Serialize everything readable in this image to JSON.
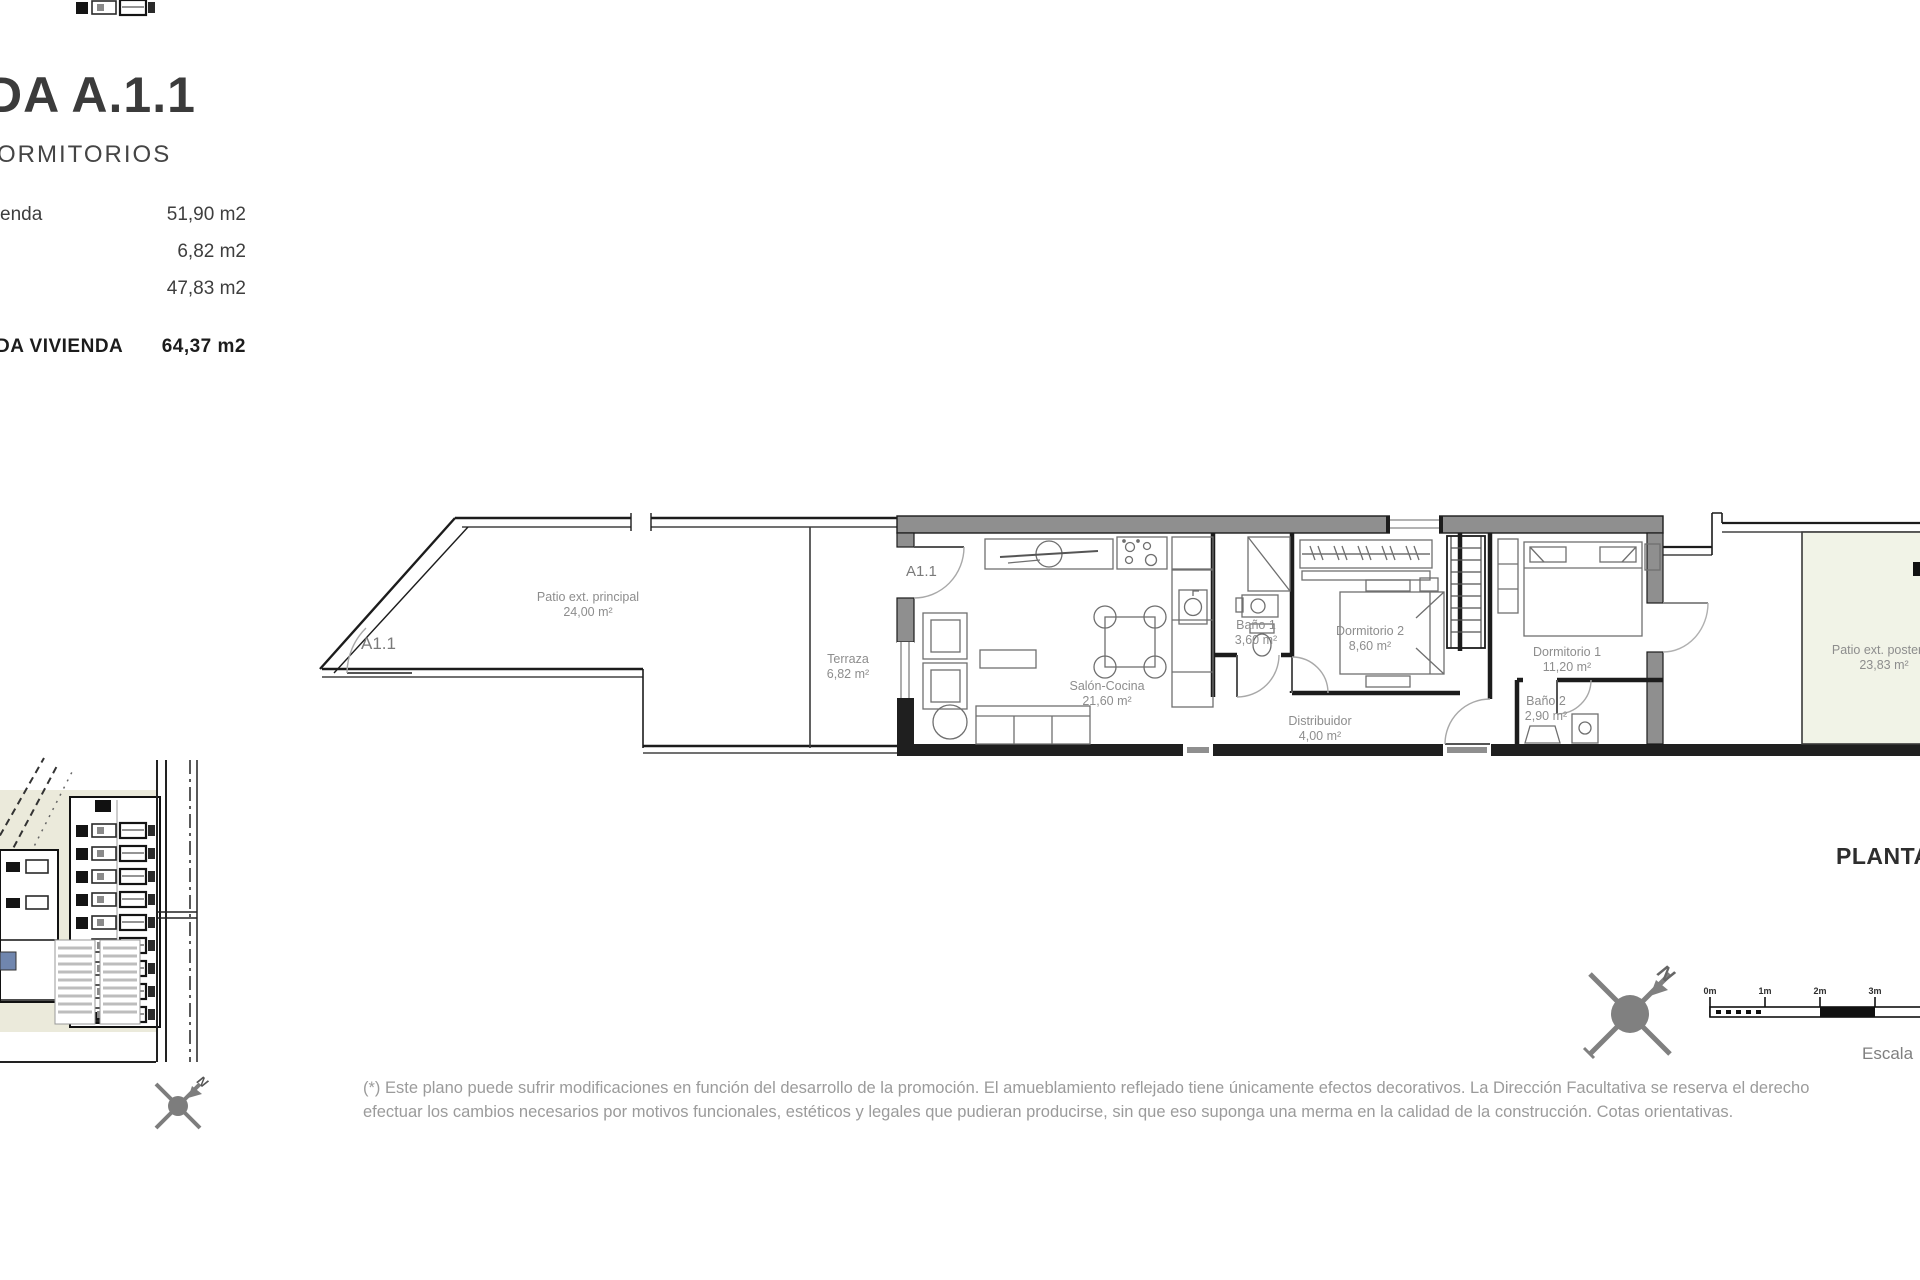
{
  "header": {
    "title": "DA A.1.1",
    "subtitle": "ORMITORIOS",
    "rows": [
      {
        "label": "enda",
        "value": "51,90 m2"
      },
      {
        "label": "",
        "value": "6,82 m2"
      },
      {
        "label": "",
        "value": "47,83 m2"
      },
      {
        "label": "DA VIVIENDA",
        "value": "64,37 m2"
      }
    ]
  },
  "plan": {
    "unit_label_patio": "A1.1",
    "unit_label_entry": "A1.1",
    "rooms": [
      {
        "name": "Patio ext. principal",
        "area": "24,00 m²"
      },
      {
        "name": "Terraza",
        "area": "6,82 m²"
      },
      {
        "name": "Salón-Cocina",
        "area": "21,60 m²"
      },
      {
        "name": "Baño 1",
        "area": "3,60 m²"
      },
      {
        "name": "Dormitorio 2",
        "area": "8,60 m²"
      },
      {
        "name": "Dormitorio 1",
        "area": "11,20 m²"
      },
      {
        "name": "Baño 2",
        "area": "2,90 m²"
      },
      {
        "name": "Distribuidor",
        "area": "4,00 m²"
      },
      {
        "name": "Patio ext. posterior",
        "area": "23,83 m²"
      }
    ],
    "plan_title": "PLANTA",
    "north_label": "N",
    "scale_label": "Escala",
    "scale_ticks": [
      "0m",
      "1m",
      "2m",
      "3m"
    ],
    "colors": {
      "wall_gray": "#8f8f8f",
      "patio_green": "#f1f3e7",
      "line_dark": "#1c1c1c",
      "label_gray": "#8d8d8d",
      "site_highlight_blue": "#7086ae"
    }
  },
  "footer": {
    "disclaimer_line1": "(*) Este plano puede sufrir modificaciones en función del desarrollo de la promoción. El amueblamiento reflejado tiene únicamente efectos decorativos. La Dirección Facultativa se reserva el derecho",
    "disclaimer_line2": "efectuar los cambios necesarios por motivos funcionales, estéticos y legales que pudieran producirse, sin que eso suponga una merma en la calidad de la construcción. Cotas orientativas."
  }
}
